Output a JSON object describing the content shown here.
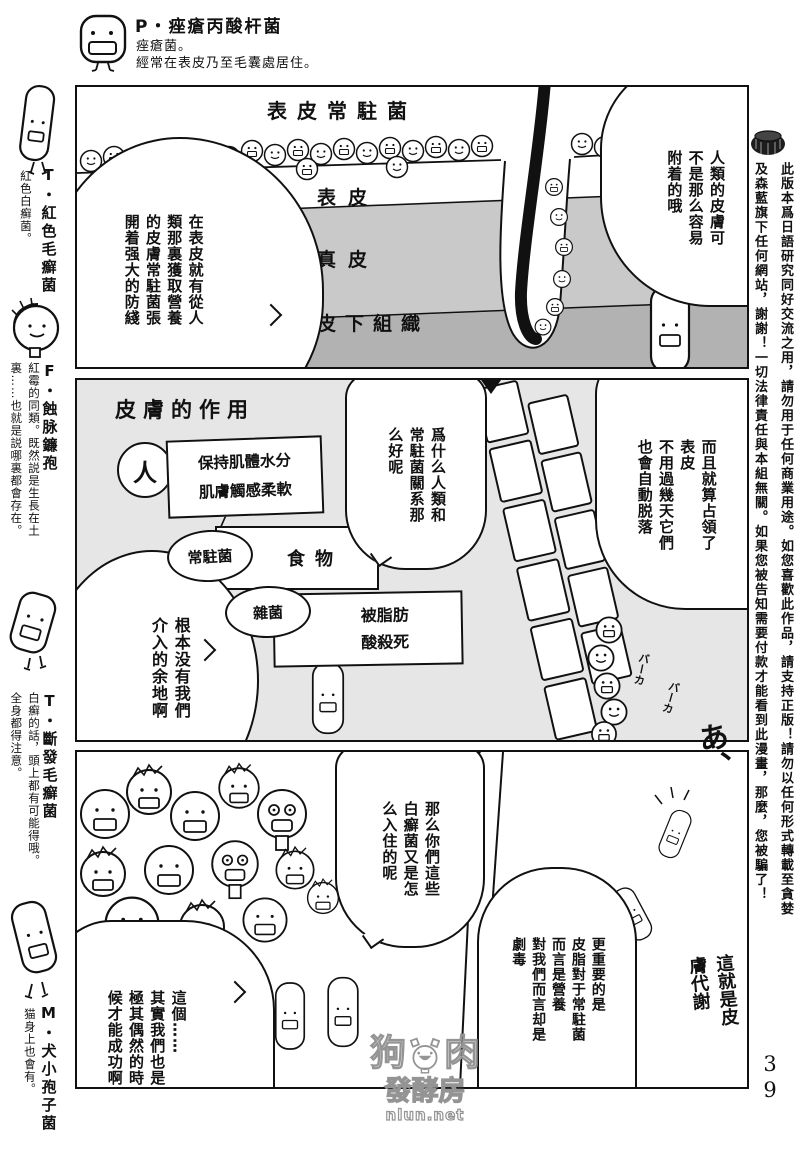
{
  "page": {
    "number": "39"
  },
  "header": {
    "title": "P・痤瘡丙酸杆菌",
    "line1": "痤瘡菌。",
    "line2": "經常在表皮乃至毛囊處居住。"
  },
  "left_margin": {
    "entries": [
      {
        "title": "T・紅色毛癬菌",
        "desc": "紅色白癬菌。"
      },
      {
        "title": "F・蝕脉鐮孢",
        "desc": "紅霉的同類。既然説是生長在土\n裏……也就是説哪裏都會存在。"
      },
      {
        "title": "T・斷發毛癬菌",
        "desc": "白癬的話，頭上都有可能得哦。\n全身都得注意。"
      },
      {
        "title": "M・犬小孢子菌",
        "desc": "猫身上也會有。"
      }
    ]
  },
  "right_margin": {
    "disclaimer": "此版本爲日語研究同好交流之用，請勿用于任何商業用途。如您喜歡此作品，請支持正版！請勿以任何形式轉載至貪婪\n及森藍旗下任何網站，謝謝！一切法律責任與本組無關。如果您被告知需要付款才能看到此漫畫，那麼，您被騙了！"
  },
  "panel1": {
    "label_top": "表皮常駐菌",
    "label_epidermis": "表皮",
    "label_dermis": "真皮",
    "label_subcutis": "皮下組織",
    "bubble_left": "在表皮就有從人\n類那裏獲取營養\n的皮膚常駐菌張\n開着强大的防綫",
    "bubble_right": "人類的皮膚可\n不是那么容易\n附着的哦"
  },
  "panel2": {
    "title": "皮膚的作用",
    "node_human": "人",
    "human_effect": "保持肌體水分\n肌膚觸感柔軟",
    "node_resident": "常駐菌",
    "resident_effect": "食物",
    "node_misc": "雜菌",
    "misc_effect": "被脂肪\n酸殺死",
    "bubble_question": "爲什么人類和\n常駐菌關系那\n么好呢",
    "bubble_left": "根本没有我們\n介入的余地啊",
    "bubble_right": "而且就算占領了\n表皮\n不用過幾天它們\n也會自動脱落",
    "sfx_baka": "バーカ",
    "sfx_ah": "あ、"
  },
  "panel3": {
    "bubble_question": "那么你們這些\n白癬菌又是怎\n么入住的呢",
    "bubble_left": "這個……\n其實我們也是\n極其偶然的時\n候才能成功啊",
    "bubble_right": "更重要的是\n皮脂對于常駐菌\n而言是營養\n對我們而言却是\n劇毒",
    "handwritten": "這就是皮\n膚代謝"
  },
  "watermark": {
    "char_left": "狗",
    "char_right": "肉",
    "line2": "發酵房",
    "url": "nlun.net"
  }
}
